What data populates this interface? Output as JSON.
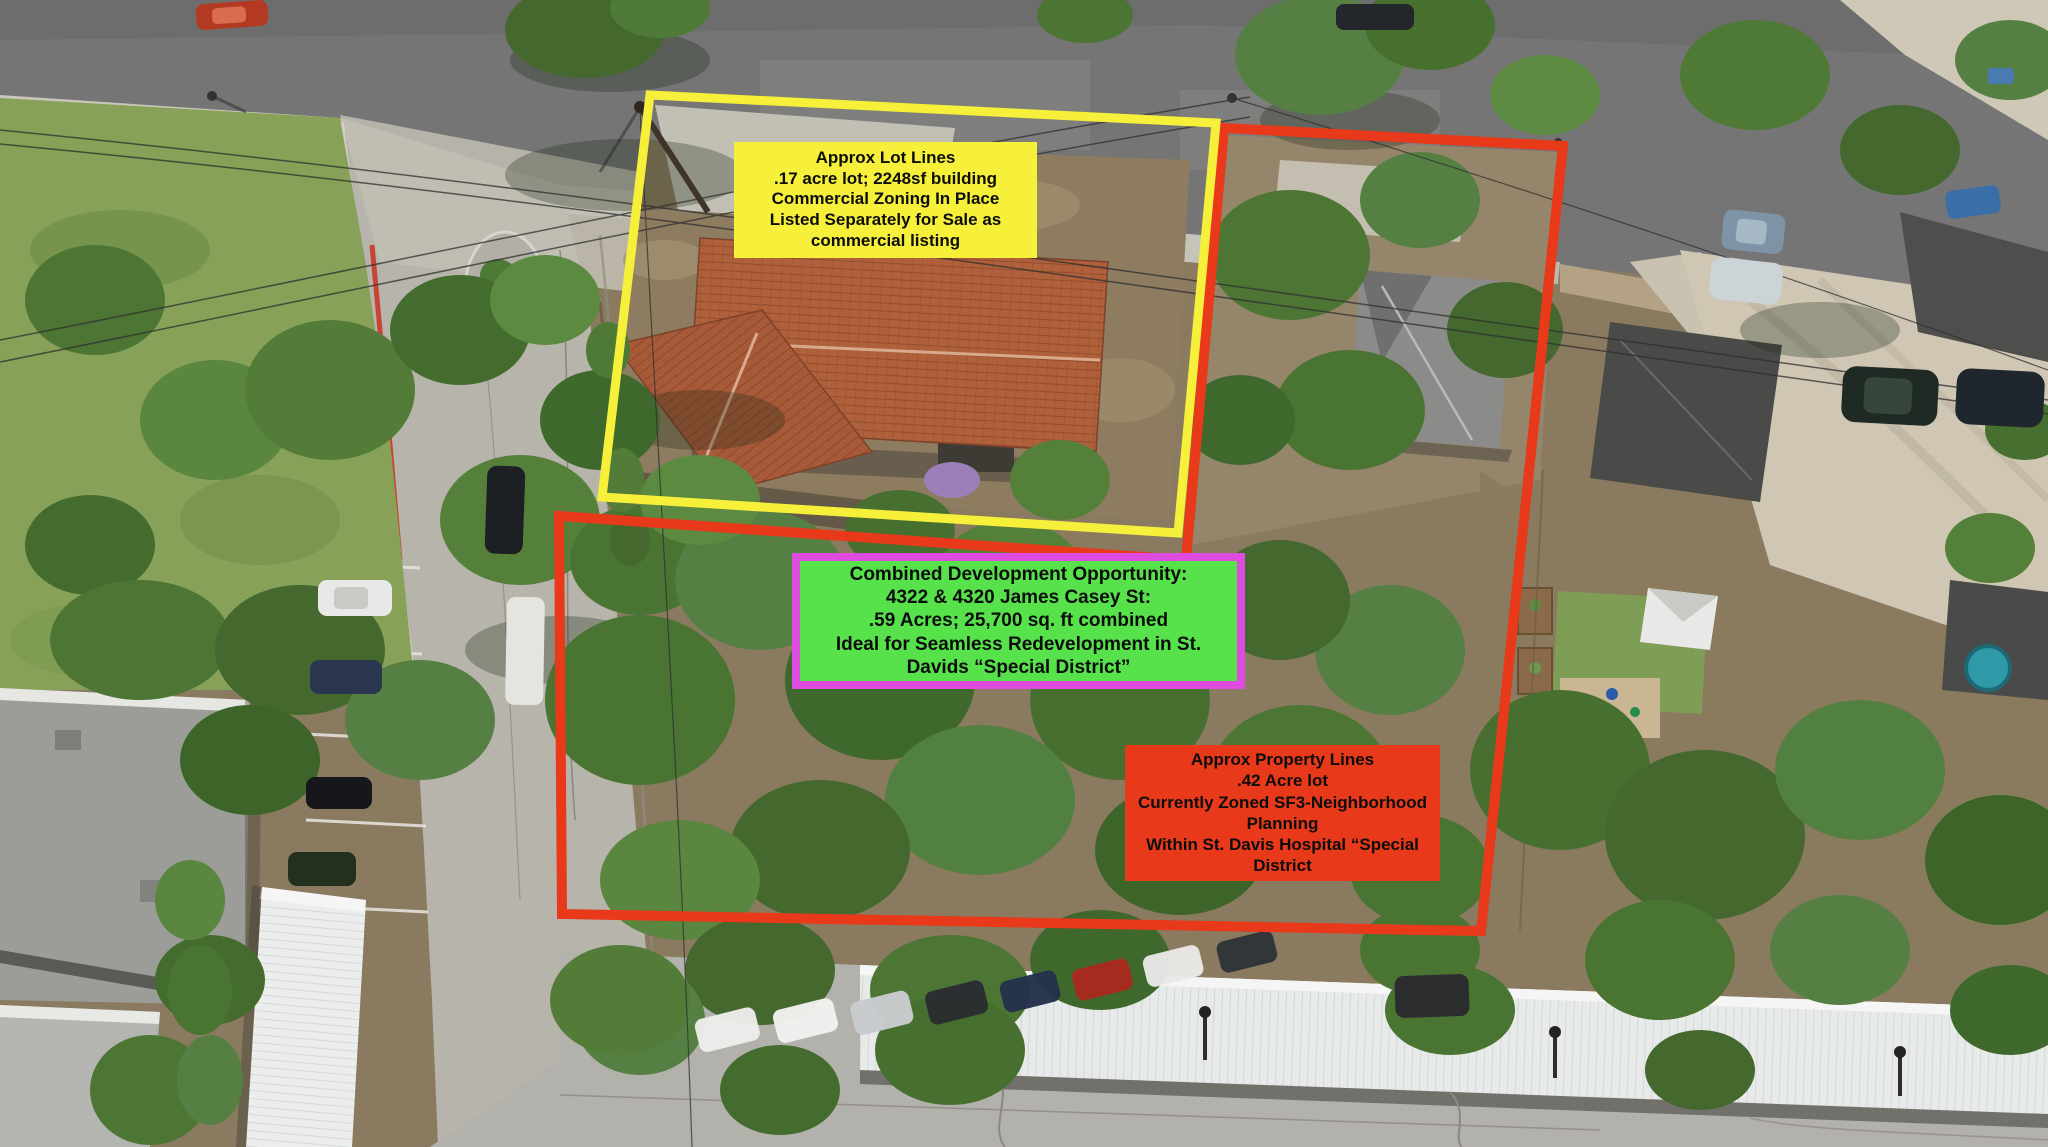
{
  "colors": {
    "lot_yellow": "#F7F03A",
    "lot_red": "#E8391B",
    "green_bg": "#57E24C",
    "green_border": "#DD4BDF",
    "label_text": "#0d0d0d"
  },
  "labels": {
    "yellow_lot": "Approx Lot Lines\n.17 acre lot; 2248sf building\nCommercial Zoning In Place\nListed Separately for Sale as\ncommercial listing",
    "combined": "Combined Development Opportunity:\n4322 & 4320 James Casey St:\n.59 Acres; 25,700 sq. ft combined\nIdeal for Seamless Redevelopment in St.\nDavids “Special District”",
    "red_lot": "Approx Property Lines\n.42 Acre lot\nCurrently Zoned SF3-Neighborhood\nPlanning\nWithin St. Davis Hospital “Special\nDistrict"
  }
}
